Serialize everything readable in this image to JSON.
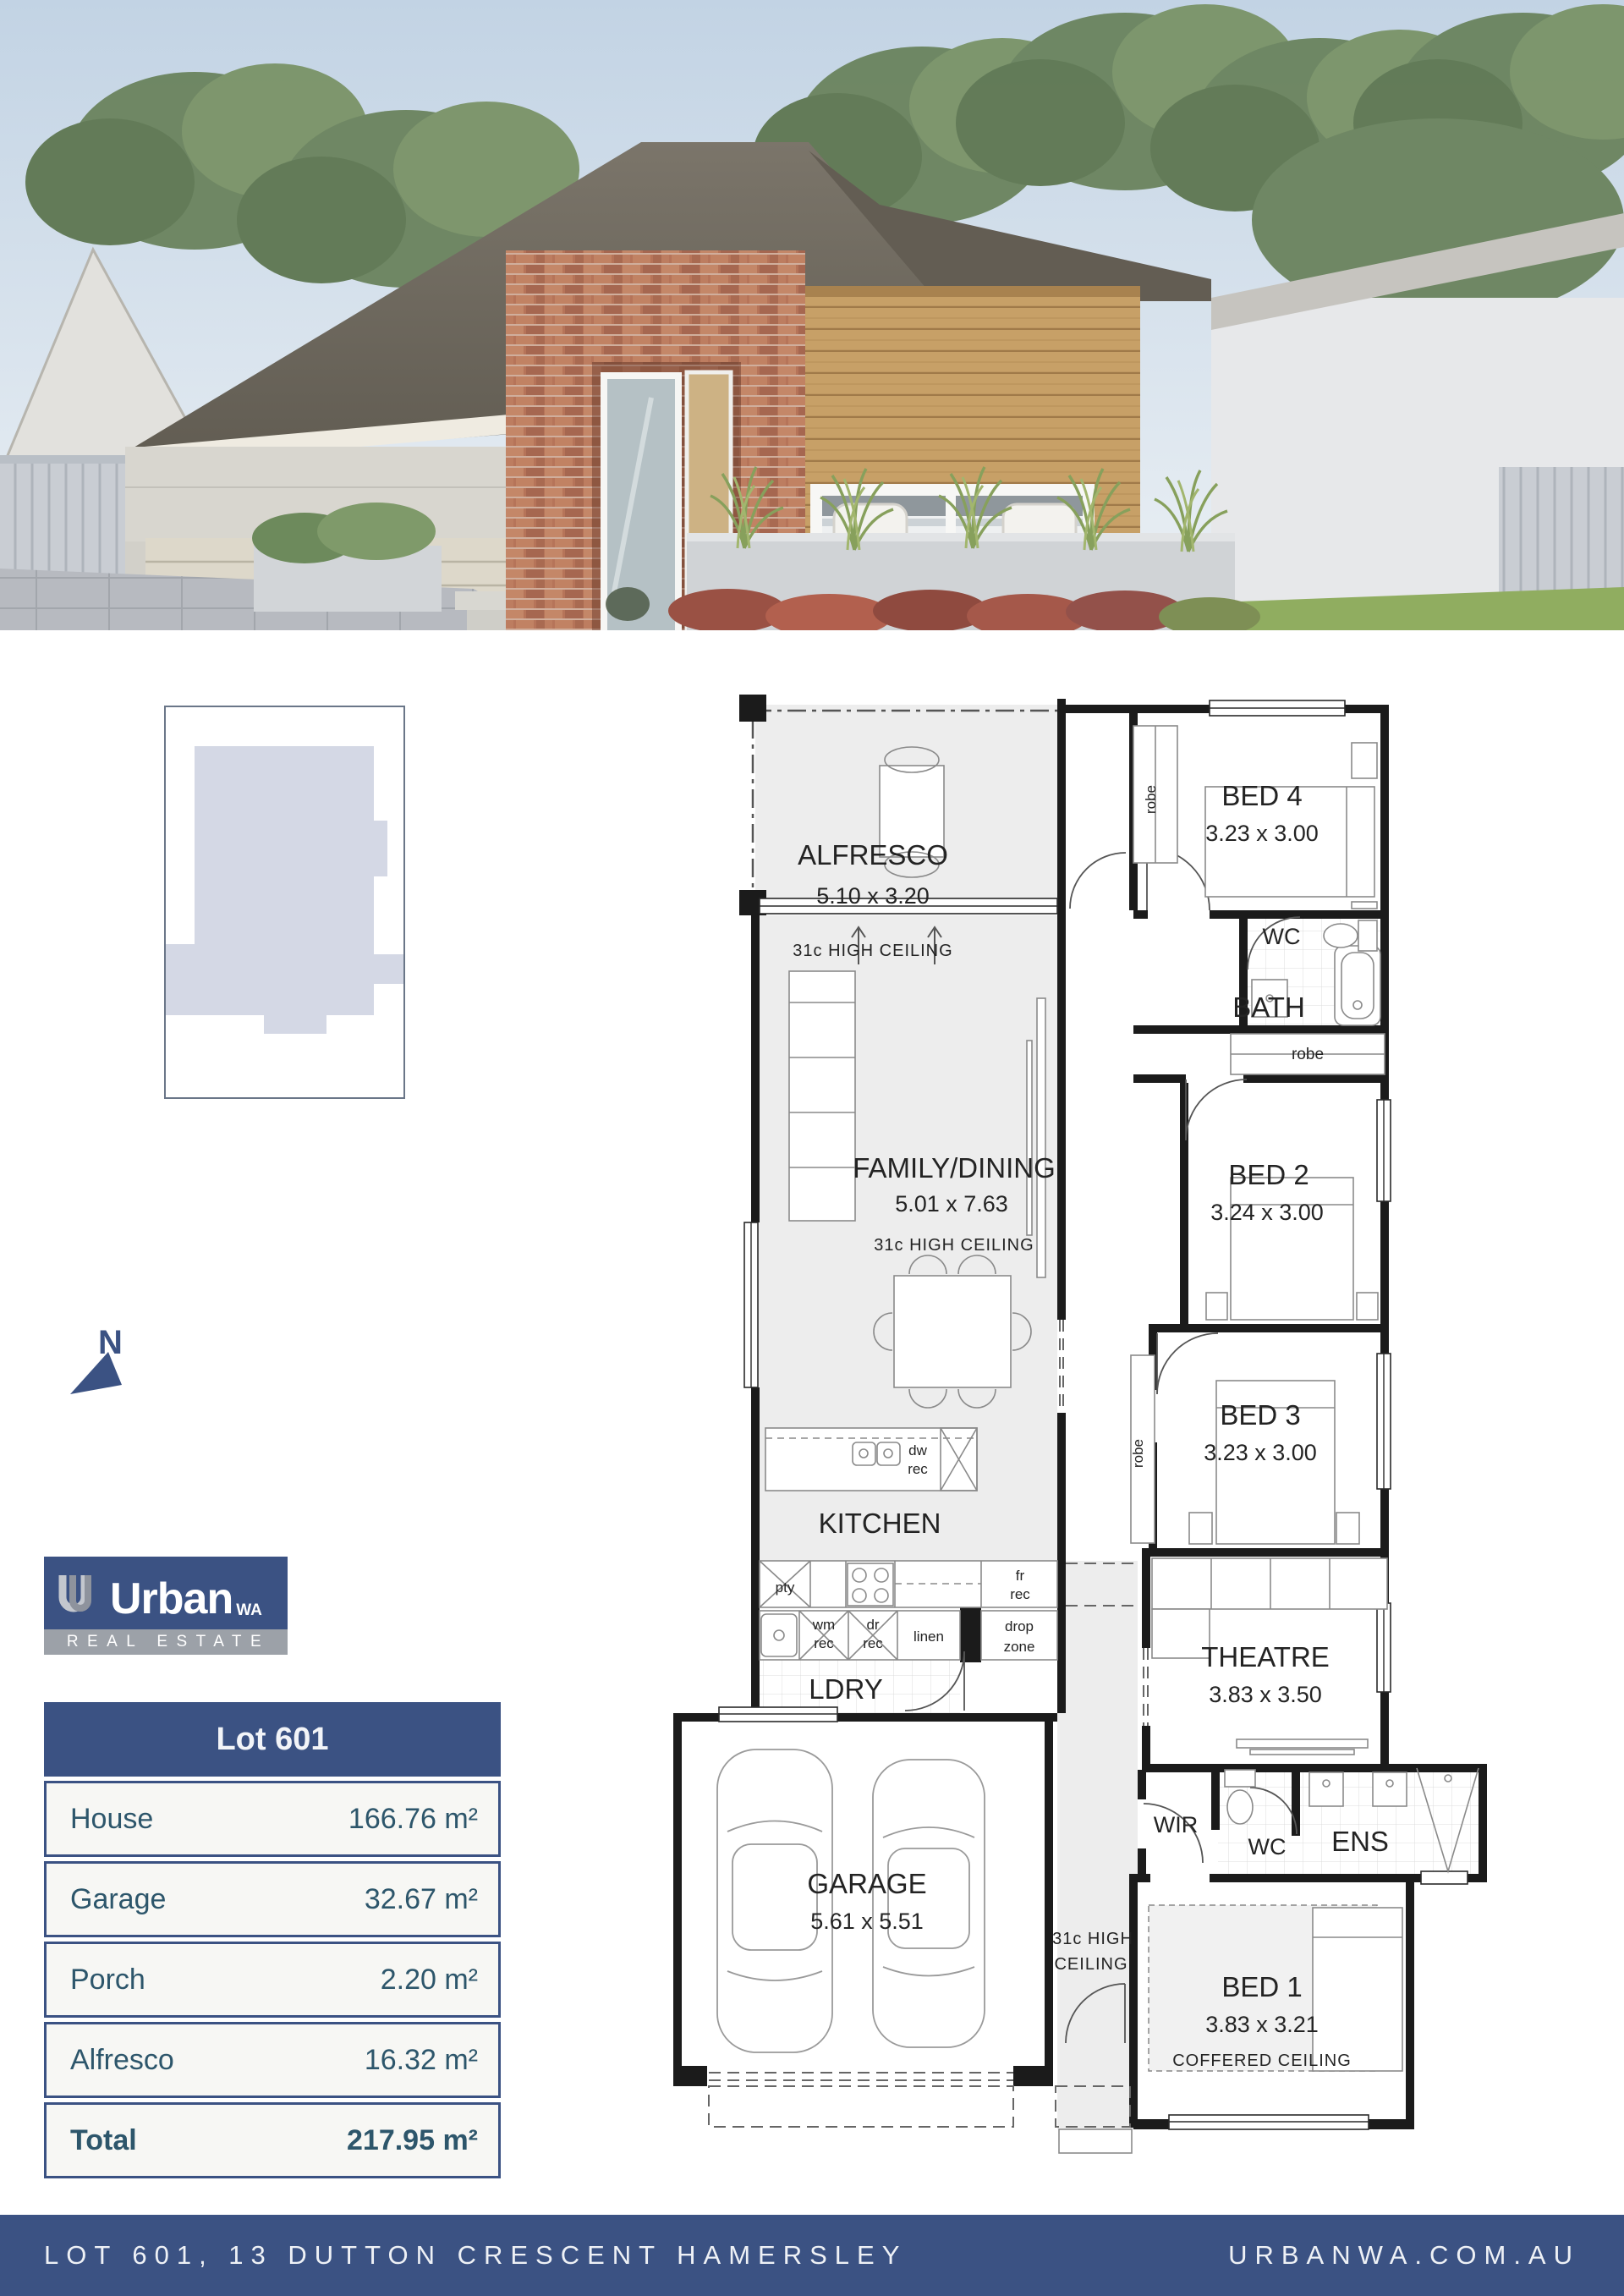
{
  "colors": {
    "navy": "#3b5283",
    "logo_gray": "#9ca1a8",
    "table_text": "#2d566b",
    "plan_wall": "#1b1b1b",
    "plan_zone_gray": "#ededed",
    "site_footprint_lavender": "#d4d8e5"
  },
  "north_arrow": {
    "label": "N"
  },
  "logo": {
    "mark": "U",
    "brand": "Urban",
    "region": "WA",
    "tagline": "REAL ESTATE"
  },
  "areas_table": {
    "header": "Lot 601",
    "rows": [
      {
        "label": "House",
        "value": "166.76 m²"
      },
      {
        "label": "Garage",
        "value": "32.67 m²"
      },
      {
        "label": "Porch",
        "value": "2.20 m²"
      },
      {
        "label": "Alfresco",
        "value": "16.32 m²"
      }
    ],
    "total": {
      "label": "Total",
      "value": "217.95 m²"
    }
  },
  "floorplan": {
    "alfresco": {
      "name": "ALFRESCO",
      "dims": "5.10 x 3.20",
      "note": "31c HIGH CEILING"
    },
    "family": {
      "name": "FAMILY/DINING",
      "dims": "5.01 x 7.63",
      "note": "31c HIGH CEILING"
    },
    "kitchen": {
      "name": "KITCHEN"
    },
    "ldry": {
      "name": "LDRY"
    },
    "garage": {
      "name": "GARAGE",
      "dims": "5.61 x 5.51"
    },
    "theatre": {
      "name": "THEATRE",
      "dims": "3.83 x 3.50"
    },
    "bed1": {
      "name": "BED 1",
      "dims": "3.83 x 3.21",
      "note": "COFFERED CEILING"
    },
    "bed2": {
      "name": "BED 2",
      "dims": "3.24 x 3.00"
    },
    "bed3": {
      "name": "BED 3",
      "dims": "3.23 x 3.00"
    },
    "bed4": {
      "name": "BED 4",
      "dims": "3.23 x 3.00"
    },
    "bath": {
      "name": "BATH"
    },
    "wc_upper": {
      "name": "WC"
    },
    "wc_lower": {
      "name": "WC"
    },
    "wir": {
      "name": "WIR"
    },
    "ens": {
      "name": "ENS"
    },
    "hall_note": {
      "line1": "31c HIGH",
      "line2": "CEILING"
    },
    "tags": {
      "robe": "robe",
      "pty": "pty",
      "dw": "dw",
      "fr": "fr",
      "wm": "wm",
      "dr": "dr",
      "rec": "rec",
      "linen": "linen",
      "drop": "drop",
      "zone": "zone"
    }
  },
  "footer": {
    "address": "LOT 601, 13 DUTTON CRESCENT HAMERSLEY",
    "website": "URBANWA.COM.AU"
  }
}
